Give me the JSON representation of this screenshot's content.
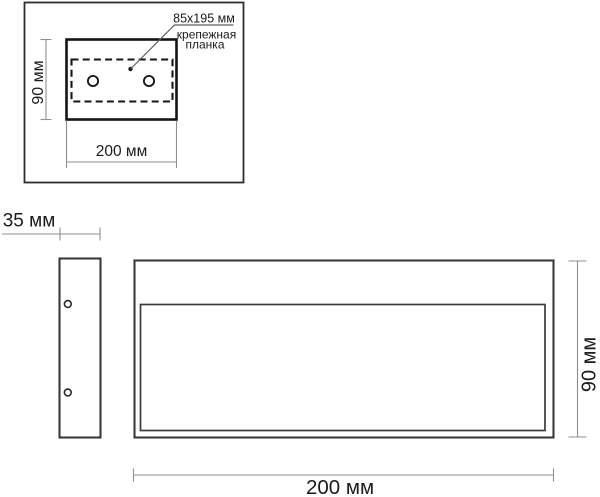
{
  "colors": {
    "background": "#ffffff",
    "main_outline": "#3a3a3a",
    "thick_outline": "#141414",
    "dimension_line": "#8f8f8f",
    "leader_line": "#5f5f5f",
    "text": "#1b1b1b"
  },
  "top_view": {
    "height_dim": "90 мм",
    "width_dim": "200 мм",
    "plate_size": "85x195 мм",
    "plate_label_line1": "крепежная",
    "plate_label_line2": "планка"
  },
  "side_view": {
    "depth_dim": "35 мм"
  },
  "front_view": {
    "height_dim": "90 мм",
    "width_dim": "200 мм"
  }
}
